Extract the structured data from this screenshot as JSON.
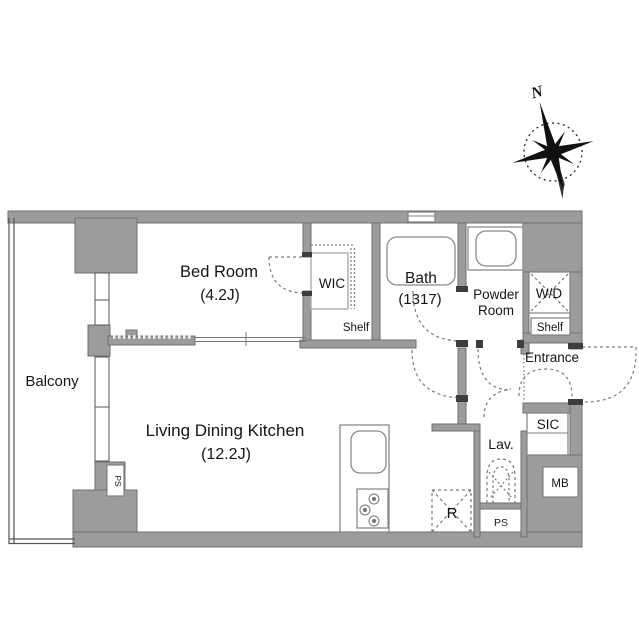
{
  "plan": {
    "type": "apartment-floor-plan",
    "compass": {
      "north_label": "N"
    },
    "colors": {
      "wall_fill": "#9c9c9c",
      "wall_stroke": "#6f6f6f",
      "line": "#555555",
      "dash": "#7a7a7a",
      "text": "#161616",
      "background": "#ffffff"
    },
    "rooms": {
      "balcony": {
        "label": "Balcony"
      },
      "bedroom": {
        "label": "Bed Room",
        "size": "(4.2J)"
      },
      "wic": {
        "label": "WIC"
      },
      "shelf_wic": {
        "label": "Shelf"
      },
      "bath": {
        "label": "Bath",
        "size": "(1317)"
      },
      "powder": {
        "label_line1": "Powder",
        "label_line2": "Room"
      },
      "wd": {
        "label": "W/D"
      },
      "shelf_entry": {
        "label": "Shelf"
      },
      "entrance": {
        "label": "Entrance"
      },
      "sic": {
        "label": "SIC"
      },
      "mb": {
        "label": "MB"
      },
      "lav": {
        "label": "Lav."
      },
      "ps_hall": {
        "label": "PS"
      },
      "ps_balcony": {
        "label": "PS"
      },
      "ldk": {
        "label": "Living Dining Kitchen",
        "size": "(12.2J)"
      },
      "fridge": {
        "label": "R"
      }
    }
  }
}
